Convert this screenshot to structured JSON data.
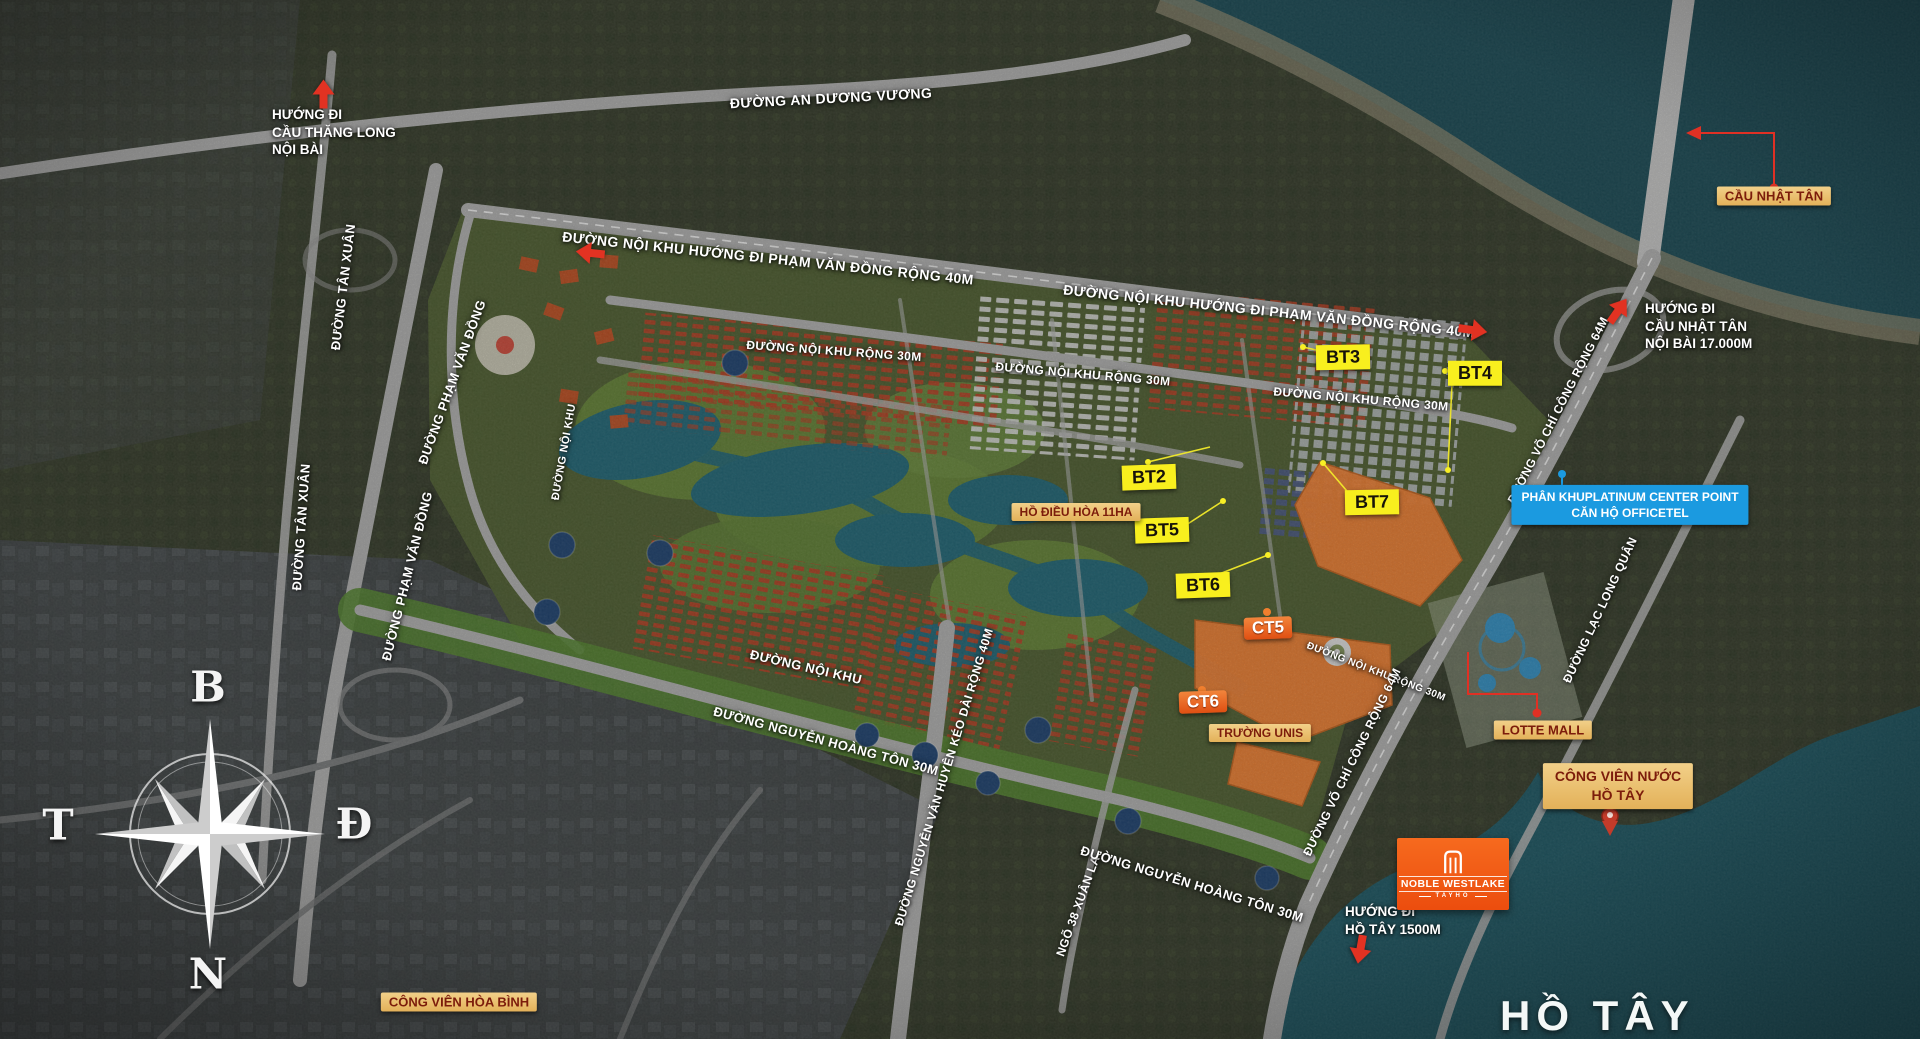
{
  "map": {
    "kind": "masterplan-satellite-map",
    "colors": {
      "badge_yellow": "#f8ef1e",
      "badge_tan": "#e9bd6b",
      "badge_blue": "#1b9ae0",
      "badge_text_red": "#7c1c0b",
      "arrow_red": "#e03024",
      "ct_orange": "#e04f12",
      "logo_orange": "#f15a17",
      "water": "#1a4d58",
      "road_gray": "#a3a3a3"
    }
  },
  "compass": {
    "north": "B",
    "east": "Đ",
    "west": "T",
    "south": "N"
  },
  "lake": {
    "name": "HỒ TÂY"
  },
  "logo": {
    "name": "NOBLE WESTLAKE",
    "sub": "TAYHO"
  },
  "directions": [
    {
      "id": "thang-long",
      "text": "HƯỚNG ĐI\nCẦU THĂNG LONG\nNỘI BÀI"
    },
    {
      "id": "nhat-tan",
      "text": "HƯỚNG ĐI\nCẦU NHẬT TÂN\nNỘI BÀI 17.000M"
    },
    {
      "id": "ho-tay",
      "text": "HƯỚNG ĐI\nHỒ TÂY 1500M"
    }
  ],
  "roads": [
    {
      "text": "ĐƯỜNG AN DƯƠNG VƯƠNG"
    },
    {
      "text": "ĐƯỜNG NỘI KHU HƯỚNG ĐI PHẠM VĂN ĐỒNG RỘNG 40M"
    },
    {
      "text": "ĐƯỜNG NỘI KHU HƯỚNG ĐI PHẠM VĂN ĐỒNG RỘNG 40M"
    },
    {
      "text": "ĐƯỜNG NỘI KHU RỘNG 30M"
    },
    {
      "text": "ĐƯỜNG NỘI KHU RỘNG 30M"
    },
    {
      "text": "ĐƯỜNG NỘI KHU RỘNG 30M"
    },
    {
      "text": "ĐƯỜNG NỘI KHU RỘNG 30M"
    },
    {
      "text": "ĐƯỜNG TÂN XUÂN"
    },
    {
      "text": "ĐƯỜNG TÂN XUÂN"
    },
    {
      "text": "ĐƯỜNG PHẠM VĂN ĐỒNG"
    },
    {
      "text": "ĐƯỜNG PHẠM VĂN ĐỒNG"
    },
    {
      "text": "ĐƯỜNG NỘI KHU"
    },
    {
      "text": "ĐƯỜNG NỘI KHU"
    },
    {
      "text": "ĐƯỜNG NGUYỄN HOÀNG TÔN 30M"
    },
    {
      "text": "ĐƯỜNG NGUYỄN VĂN HUYÊN KÉO DÀI RỘNG 40M"
    },
    {
      "text": "NGÕ 38 XUÂN LA"
    },
    {
      "text": "ĐƯỜNG NGUYỄN HOÀNG TÔN 30M"
    },
    {
      "text": "ĐƯỜNG VÕ CHÍ CÔNG RỘNG 64M"
    },
    {
      "text": "ĐƯỜNG VÕ CHÍ CÔNG RỘNG 64M"
    },
    {
      "text": "ĐƯỜNG LẠC LONG QUÂN"
    }
  ],
  "zones": [
    {
      "label": "BT3"
    },
    {
      "label": "BT4"
    },
    {
      "label": "BT2"
    },
    {
      "label": "BT7"
    },
    {
      "label": "BT5"
    },
    {
      "label": "BT6"
    },
    {
      "label": "CT5"
    },
    {
      "label": "CT6"
    }
  ],
  "places": [
    {
      "label": "CẦU NHẬT TÂN"
    },
    {
      "label": "HỒ ĐIỀU HÒA 11HA"
    },
    {
      "label": "TRƯỜNG UNIS"
    },
    {
      "label": "LOTTE MALL"
    },
    {
      "line1": "CÔNG VIÊN NƯỚC",
      "line2": "HỒ TÂY"
    },
    {
      "label": "CÔNG VIÊN HÒA BÌNH"
    },
    {
      "line1": "PHÂN KHUPLATINUM CENTER POINT",
      "line2": "CĂN HỘ OFFICETEL"
    }
  ]
}
